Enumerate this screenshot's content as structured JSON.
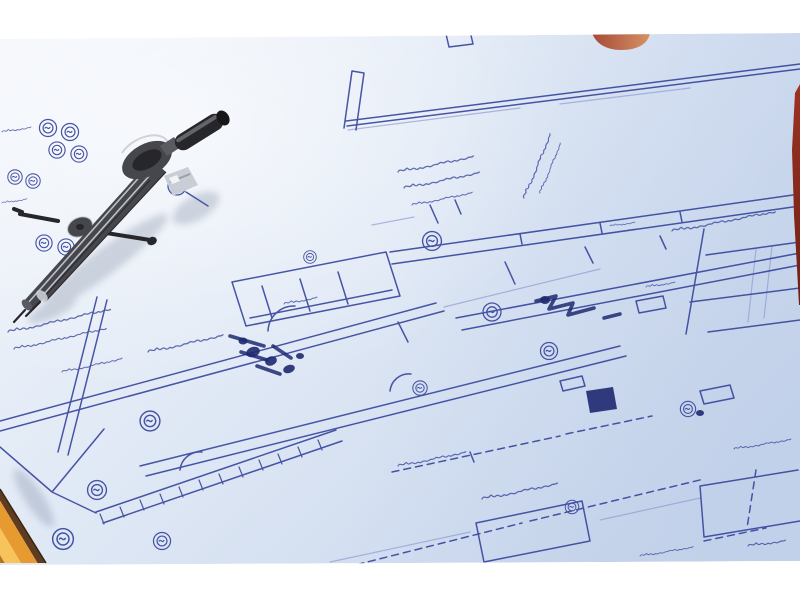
{
  "scene": {
    "kind": "photograph",
    "objects": {
      "paper": "blueprint floor plan sheet",
      "compass": "steel drafting compass divider",
      "pencil": "yellow pencil tip lower-left corner",
      "orange_object": "orange object at top edge",
      "red_object": "red object sliver at right edge",
      "frame": "white photo border"
    }
  },
  "colors": {
    "frame_white": "#ffffff",
    "paper_light": "#f3f6fb",
    "paper_mid": "#dfe8f5",
    "paper_shade": "#c8d6ec",
    "ink_primary": "#35439b",
    "ink_faint": "#8a96cf",
    "ink_dark": "#1e2a70",
    "compass_body": "#46474d",
    "compass_dark": "#26262b",
    "compass_mid": "#5a5b62",
    "compass_highlight": "#c9ced6",
    "compass_glint": "#f1f3f6",
    "shadow": "#5c6a86",
    "pencil_edge": "#5e3c20",
    "pencil_body": "#e79a2f",
    "pencil_light": "#f7c45c",
    "pencil_deep": "#b9741f",
    "orange_dark": "#a64a36",
    "orange_light": "#d69166",
    "red_dark": "#9c3322",
    "red_deep": "#701f15"
  }
}
